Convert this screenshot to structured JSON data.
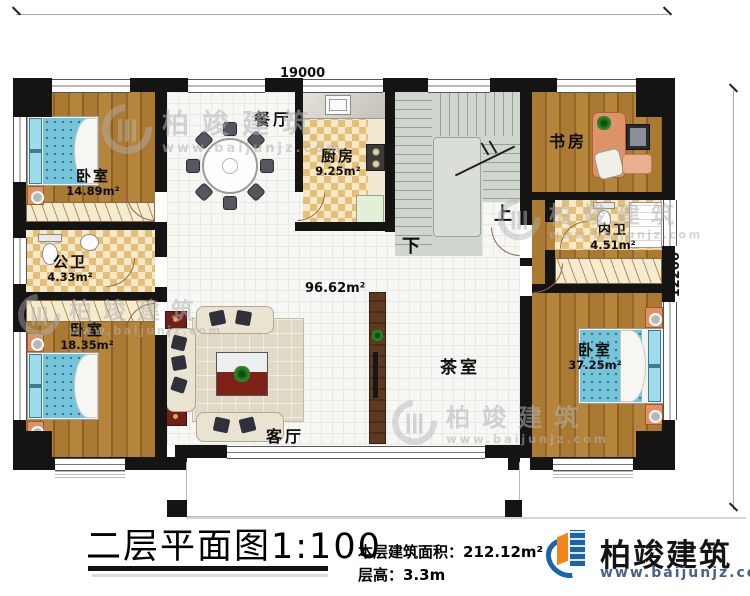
{
  "colors": {
    "wall": "#141414",
    "wood_floor": "#aa7a33",
    "checker_dark": "#e6bf76",
    "checker_light": "#f6e9c9",
    "stairs": "#cfd6cd",
    "bed_blue": "#74c4da",
    "brand_blue": "#1b63ad",
    "brand_orange": "#f08519"
  },
  "dimensions": {
    "top": "19000",
    "right": "12200"
  },
  "stairs": {
    "up_label": "上",
    "down_label": "下"
  },
  "rooms": {
    "bedroom_top_left": {
      "name": "卧室",
      "area": "14.89m²"
    },
    "public_bath": {
      "name": "公卫",
      "area": "4.33m²"
    },
    "bedroom_bottom_left": {
      "name": "卧室",
      "area": "18.35m²"
    },
    "dining": {
      "name": "餐厅"
    },
    "kitchen": {
      "name": "厨房",
      "area": "9.25m²"
    },
    "study": {
      "name": "书房"
    },
    "ensuite_bath": {
      "name": "内卫",
      "area": "4.51m²"
    },
    "bedroom_right": {
      "name": "卧室",
      "area": "37.25m²"
    },
    "living": {
      "name": "客厅"
    },
    "tea_room": {
      "name": "茶室"
    },
    "hall_area": "96.62m²"
  },
  "footer": {
    "plan_title": "二层平面图1:100",
    "floor_area_label": "本层建筑面积：",
    "floor_area_value": "212.12m²",
    "floor_height_label": "层高：",
    "floor_height_value": "3.3m"
  },
  "brand": {
    "name": "柏竣建筑",
    "url": "www.baijunjz.com"
  },
  "watermark": {
    "name": "柏竣建筑",
    "url": "www.baijunjz.com"
  }
}
